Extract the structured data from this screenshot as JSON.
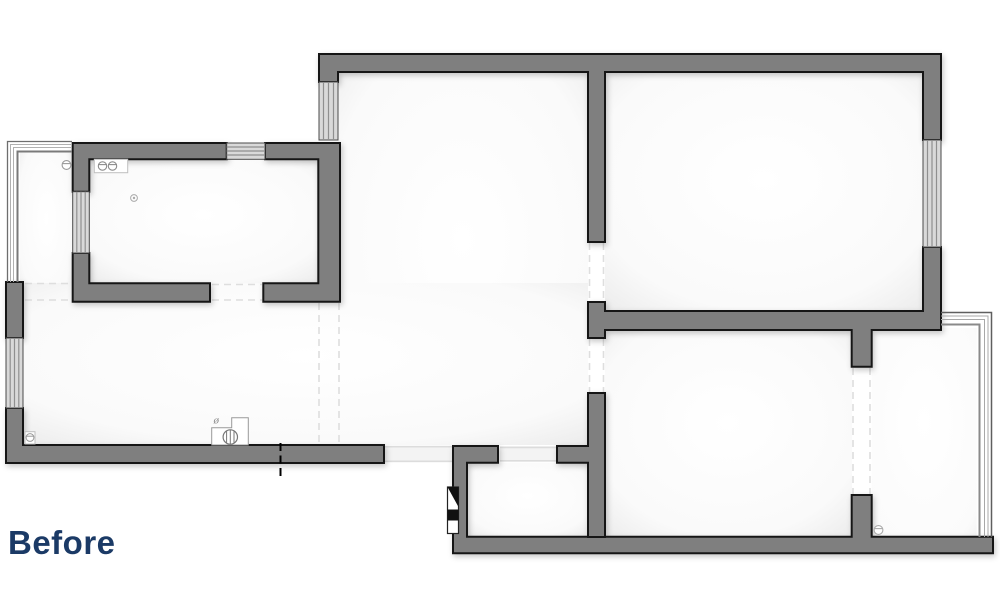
{
  "title": {
    "label": "Before"
  },
  "colors": {
    "wall": "#7f7f7f",
    "outline": "#161616",
    "label": "#1b3a66",
    "glass_bg": "#d9d9d9",
    "glass_line": "#8f8f8f",
    "ghost": "#dedede",
    "symbol": "#8c8c8c",
    "door_mark": "#000000"
  },
  "symbols": {
    "diameter_mark": "ø"
  },
  "icons": [
    {
      "name": "cooktop-icon",
      "meaning": "kitchen cooktop with two burner knobs"
    },
    {
      "name": "service-circle-icon",
      "meaning": "circle valve mark left of kitchen wall"
    },
    {
      "name": "ceiling-light-icon",
      "meaning": "small double-circle ceiling point in kitchen"
    },
    {
      "name": "radiator-valve-icon",
      "meaning": "valve box at lower-left wall"
    },
    {
      "name": "boiler-icon",
      "meaning": "stepped boiler unit with hatched circle on bottom wall"
    },
    {
      "name": "valve-icon",
      "meaning": "circle valve mark at bottom-right wall"
    },
    {
      "name": "entry-door-icon",
      "meaning": "black/white entry door marker on hall wall"
    },
    {
      "name": "section-mark",
      "meaning": "black dashed cut line through bottom wall"
    }
  ]
}
